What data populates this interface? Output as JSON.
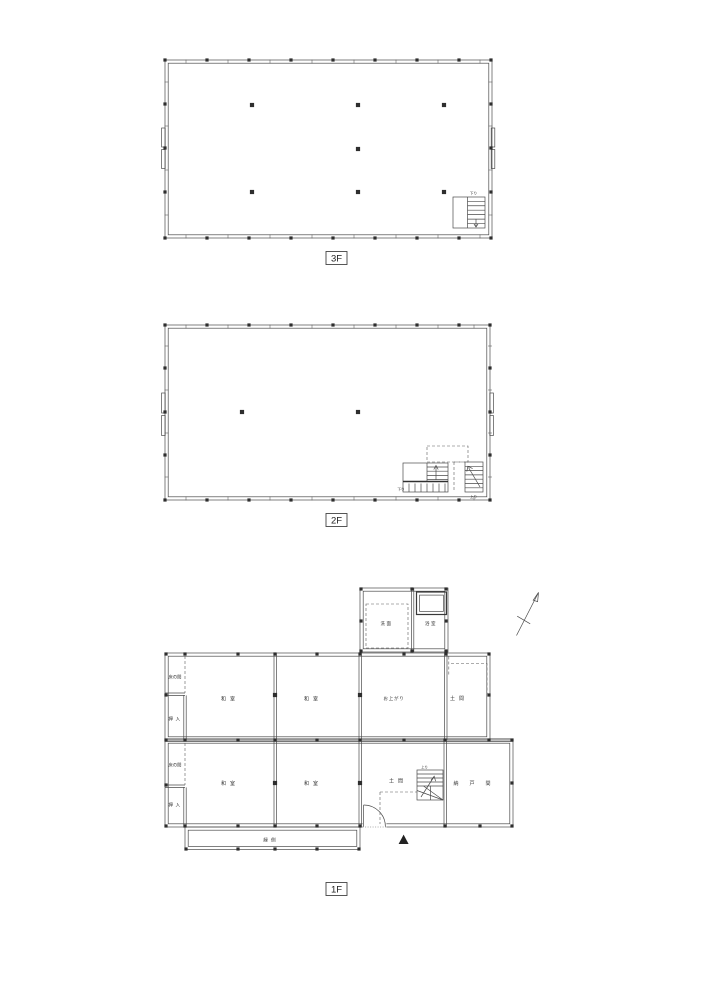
{
  "document": {
    "type": "architectural-floor-plans",
    "colors": {
      "background": "#ffffff",
      "line": "#4a4a4a",
      "post": "#2e2e2e"
    }
  },
  "floors": {
    "f3": {
      "label": "3F",
      "stair_down": "下り"
    },
    "f2": {
      "label": "2F",
      "stair_down": "下り",
      "stair_up": "上り"
    },
    "f1": {
      "label": "1F",
      "stair_up": "上り",
      "rooms": {
        "senmen": "洗面",
        "yokushitsu": "浴室",
        "tokonoma_u": "床の間",
        "oshiire_u": "押入",
        "washitsu_ul": "和室",
        "washitsu_ur": "和室",
        "oagari": "お上がり",
        "doma_u": "土間",
        "tokonoma_l": "床の間",
        "oshiire_l": "押入",
        "washitsu_ll": "和室",
        "washitsu_lr": "和室",
        "doma_l": "土間",
        "nando": "納戸間",
        "engawa": "縁側"
      }
    }
  }
}
